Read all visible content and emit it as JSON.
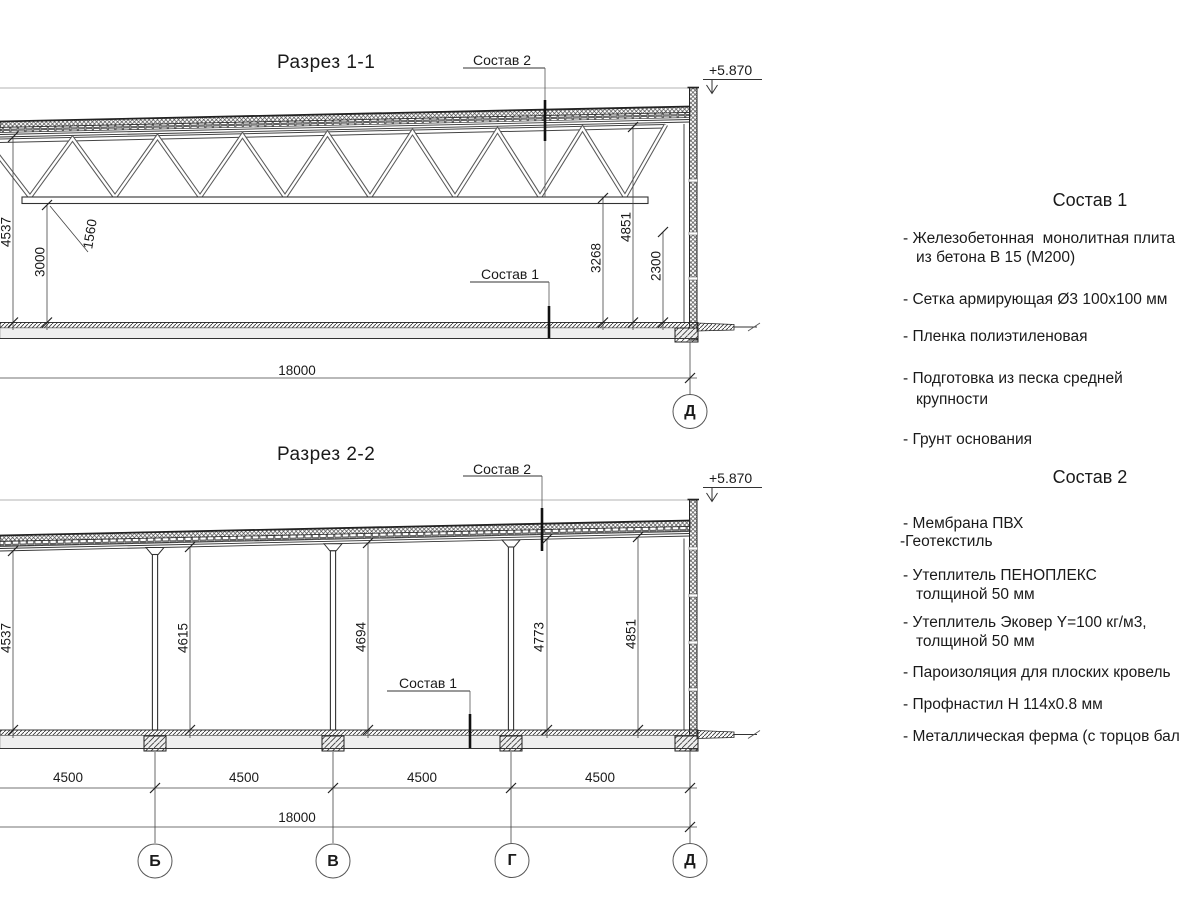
{
  "drawing": {
    "section1": {
      "title": "Разрез 1-1",
      "callout_sostav2": "Состав 2",
      "callout_sostav1": "Состав 1",
      "elevation": "+5.870",
      "dim_left_height": "4537",
      "dim_truss_height": "1560",
      "dim_clear_height": "3000",
      "dim_3268": "3268",
      "dim_4851": "4851",
      "dim_2300": "2300",
      "dim_span": "18000",
      "axis_right": "Д"
    },
    "section2": {
      "title": "Разрез 2-2",
      "callout_sostav2": "Состав 2",
      "callout_sostav1": "Состав 1",
      "elevation": "+5.870",
      "dim_h1": "4537",
      "dim_h2": "4615",
      "dim_h3": "4694",
      "dim_h4": "4773",
      "dim_h5": "4851",
      "bay1": "4500",
      "bay2": "4500",
      "bay3": "4500",
      "bay4": "4500",
      "dim_span": "18000",
      "axis1": "Б",
      "axis2": "В",
      "axis3": "Г",
      "axis4": "Д"
    }
  },
  "notes": {
    "s1_title": "Состав 1",
    "s1_i1a": "- Железобетонная  монолитная плита",
    "s1_i1b": "из бетона В 15 (М200)",
    "s1_i2": "- Сетка армирующая Ø3 100х100 мм",
    "s1_i3": "- Пленка полиэтиленовая",
    "s1_i4a": "- Подготовка из песка средней",
    "s1_i4b": "крупности",
    "s1_i5": "- Грунт основания",
    "s2_title": "Состав 2",
    "s2_i1": "- Мембрана ПВХ",
    "s2_i2": "-Геотекстиль",
    "s2_i3a": "- Утеплитель ПЕНОПЛЕКС",
    "s2_i3b": "толщиной 50 мм",
    "s2_i4a": "- Утеплитель Эковер Y=100 кг/м3,",
    "s2_i4b": "толщиной 50 мм",
    "s2_i5": "- Пароизоляция для плоских кровель",
    "s2_i6": "- Профнастил Н 114х0.8 мм",
    "s2_i7": "- Металлическая ферма (с торцов бал"
  },
  "colors": {
    "line": "#2b2b2b",
    "text": "#1a1a1a",
    "background": "#ffffff"
  }
}
